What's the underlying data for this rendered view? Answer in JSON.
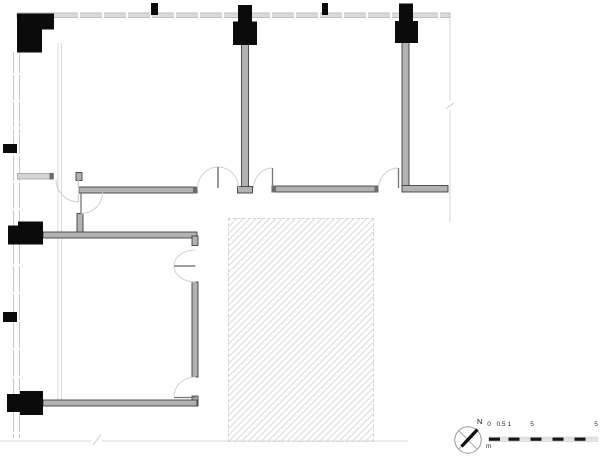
{
  "meta": {
    "drawing_type": "architectural floor plan, partial, with hatched void area"
  },
  "compass": {
    "north_label": "N",
    "geometry": {
      "cx": 468,
      "cy": 440,
      "r": 13.2,
      "cross_r": 9.3,
      "needle": [
        461.5,
        446.5,
        477.5,
        429.5
      ],
      "circle_stroke": "#9a9a9a",
      "cross_stroke": "#a0a0a0",
      "needle_color": "#111111"
    }
  },
  "scale_bar": {
    "unit_label": "m",
    "tick_labels": [
      "0",
      "0.5",
      "1",
      "5",
      "5"
    ],
    "tick_positions_px": [
      489,
      501,
      509.5,
      532,
      596
    ],
    "labels_top_px": 421,
    "bar": {
      "x": 489,
      "y": 437.6,
      "height": 3.2,
      "outline": "#bbbbbb",
      "segments": [
        {
          "w": 11,
          "color": "#161616"
        },
        {
          "w": 8.5,
          "color": "#e3e3e3"
        },
        {
          "w": 11,
          "color": "#161616"
        },
        {
          "w": 11,
          "color": "#e3e3e3"
        },
        {
          "w": 11,
          "color": "#161616"
        },
        {
          "w": 11,
          "color": "#e3e3e3"
        },
        {
          "w": 11,
          "color": "#161616"
        },
        {
          "w": 11,
          "color": "#e3e3e3"
        },
        {
          "w": 11,
          "color": "#161616"
        },
        {
          "w": 11.5,
          "color": "#e3e3e3"
        }
      ]
    }
  },
  "colors": {
    "column_fill": "#0b0b0b",
    "wall_dark_fill": "#b2b2b2",
    "wall_dark_stroke": "#404040",
    "wall_light_fill": "#d6d6d6",
    "wall_light_stroke": "#9e9e9e",
    "cap_fill": "#6b6b6b",
    "boundary": "#c9c9c9",
    "boundary_faint": "#dadada",
    "door_arc": "#d2d2d2",
    "door_leaf": "#777777"
  },
  "plan": {
    "boundary": {
      "left_lines": [
        {
          "x": 13.5,
          "y1": 52,
          "y2": 438
        },
        {
          "x": 19.5,
          "y1": 52,
          "y2": 438
        }
      ],
      "inner_lines": [
        {
          "x": 58,
          "y1": 43,
          "y2": 400
        },
        {
          "x": 61.5,
          "y1": 43,
          "y2": 400
        }
      ],
      "top_band": {
        "x": 17,
        "y": 13,
        "w": 433,
        "h": 4.5
      },
      "right_line": {
        "x": 450,
        "y1": 17,
        "y2": 222
      },
      "bottom_line": {
        "y": 441,
        "x1": 0,
        "x2": 408
      },
      "top_ticks_x": [
        78,
        102,
        126,
        150,
        174,
        198,
        222,
        270,
        294,
        318,
        342,
        366,
        390,
        438
      ],
      "left_ticks_y": [
        73,
        100,
        127,
        154,
        181,
        208,
        264,
        292,
        320,
        348,
        376,
        432
      ]
    },
    "walls": [
      {
        "x": 241.5,
        "y": 44,
        "w": 7,
        "h": 144,
        "type": "dark"
      },
      {
        "x": 237.5,
        "y": 186.5,
        "w": 15,
        "h": 6.5,
        "type": "dark"
      },
      {
        "x": 402,
        "y": 42,
        "w": 7,
        "h": 145,
        "type": "dark"
      },
      {
        "x": 402,
        "y": 185.5,
        "w": 46,
        "h": 6.5,
        "type": "dark"
      },
      {
        "x": 17.5,
        "y": 173.5,
        "w": 36,
        "h": 5.5,
        "type": "light"
      },
      {
        "x": 76,
        "y": 172.5,
        "w": 6,
        "h": 8,
        "type": "dark"
      },
      {
        "x": 79,
        "y": 187,
        "w": 118,
        "h": 6,
        "type": "dark"
      },
      {
        "x": 272,
        "y": 186,
        "w": 106,
        "h": 6,
        "type": "dark"
      },
      {
        "x": 77,
        "y": 213.5,
        "w": 6,
        "h": 20,
        "type": "dark"
      },
      {
        "x": 43,
        "y": 232,
        "w": 154,
        "h": 6,
        "type": "dark"
      },
      {
        "x": 192,
        "y": 236,
        "w": 6,
        "h": 9.5,
        "type": "dark"
      },
      {
        "x": 192,
        "y": 282,
        "w": 6,
        "h": 95,
        "type": "dark"
      },
      {
        "x": 192,
        "y": 396,
        "w": 6,
        "h": 10,
        "type": "dark"
      },
      {
        "x": 43,
        "y": 400,
        "w": 154,
        "h": 6,
        "type": "dark"
      }
    ],
    "caps": [
      {
        "x": 49.5,
        "y": 173,
        "w": 4,
        "h": 6.5
      },
      {
        "x": 193,
        "y": 186.5,
        "w": 4,
        "h": 7
      },
      {
        "x": 272,
        "y": 185.5,
        "w": 4,
        "h": 7
      },
      {
        "x": 374.5,
        "y": 185.5,
        "w": 4,
        "h": 7
      }
    ],
    "columns": [
      {
        "x": 17,
        "y": 13.5,
        "w": 25,
        "h": 39
      },
      {
        "x": 42,
        "y": 13.5,
        "w": 12,
        "h": 16
      },
      {
        "x": 151,
        "y": 3,
        "w": 7,
        "h": 12
      },
      {
        "x": 238,
        "y": 5,
        "w": 14,
        "h": 17
      },
      {
        "x": 233,
        "y": 21.5,
        "w": 24,
        "h": 23.5
      },
      {
        "x": 322,
        "y": 3,
        "w": 6,
        "h": 12
      },
      {
        "x": 399,
        "y": 3.5,
        "w": 14,
        "h": 18
      },
      {
        "x": 395,
        "y": 21,
        "w": 23,
        "h": 22
      },
      {
        "x": 3,
        "y": 144,
        "w": 14,
        "h": 9
      },
      {
        "x": 18,
        "y": 221.5,
        "w": 25,
        "h": 23
      },
      {
        "x": 8,
        "y": 225.5,
        "w": 10,
        "h": 19
      },
      {
        "x": 3,
        "y": 312,
        "w": 14,
        "h": 10
      },
      {
        "x": 20,
        "y": 391,
        "w": 23,
        "h": 24
      },
      {
        "x": 7,
        "y": 394,
        "w": 13,
        "h": 18
      }
    ],
    "doors": [
      {
        "arc": "M 56 179.5 A 22.5 22.5 0 0 0 78.5 202",
        "leaf": [
          78.5,
          180,
          78.5,
          202
        ],
        "leaf_stroke": "#cccccc"
      },
      {
        "arc": "M 81 213.5 A 21.5 21 0 0 0 102.5 192.5",
        "leaf": [
          81,
          193,
          81,
          213.5
        ]
      },
      {
        "arc": "M 197.5 188.5 A 20.5 21.5 0 0 1 218 167",
        "leaf": [
          218,
          167,
          218,
          188
        ]
      },
      {
        "arc": "M 218 167 A 20.5 21.5 0 0 1 238.5 188.5",
        "leaf": [
          218,
          167,
          218,
          188
        ]
      },
      {
        "arc": "M 253.5 188.5 A 19 20.5 0 0 1 272.5 168",
        "leaf": [
          272.5,
          168,
          272.5,
          188
        ]
      },
      {
        "arc": "M 378.5 188.5 A 20 20.5 0 0 1 398.5 168",
        "leaf": [
          398.5,
          168,
          398.5,
          188
        ]
      },
      {
        "arc": "M 195.5 250 A 21.5 15.5 0 0 0 174 265.5",
        "leaf": [
          174,
          266,
          195.5,
          266
        ]
      },
      {
        "arc": "M 195.5 282 A 21.5 15.5 0 0 1 174 266.5",
        "leaf": [
          174,
          266,
          195.5,
          266
        ]
      },
      {
        "arc": "M 195.5 377 A 21.5 19.5 0 0 0 174 396.5",
        "leaf": [
          174,
          397.5,
          195.5,
          397.5
        ]
      }
    ],
    "breaks": [
      {
        "gap": [
          447,
          101,
          6,
          9
        ],
        "line": [
          446,
          108.5,
          454,
          103
        ]
      },
      {
        "gap": [
          91,
          438.5,
          11,
          5
        ],
        "line": [
          93,
          445,
          101,
          434.5
        ]
      }
    ],
    "hatch": {
      "x": 227.5,
      "y": 218,
      "w": 146,
      "h": 224,
      "line_color": "#dcdcdc",
      "spacing": 4.6,
      "line_w": 1.1,
      "border": "#d6d6d6"
    }
  }
}
